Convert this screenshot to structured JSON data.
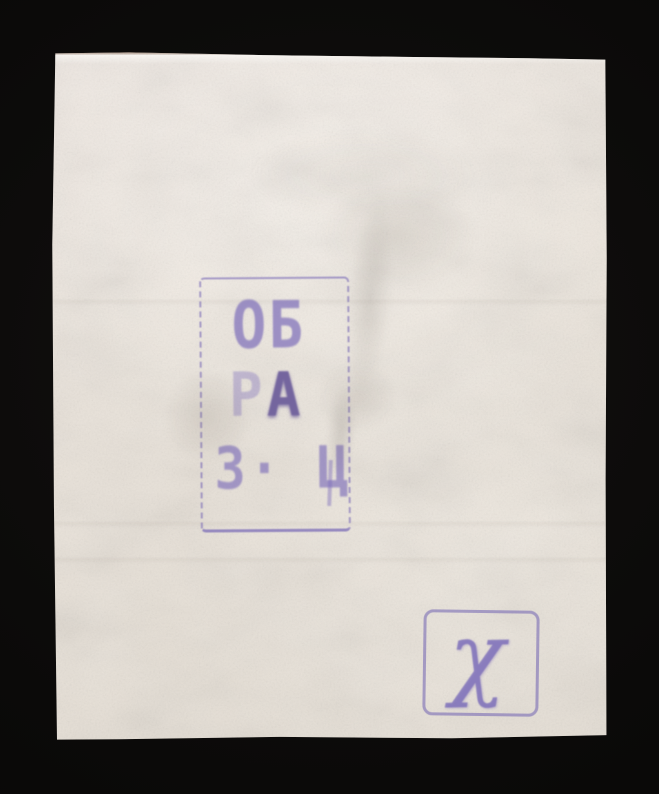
{
  "colors": {
    "background": "#0b0a09",
    "paper": "#eae3da",
    "ink": "#7e6fba",
    "ink_dark": "#655597"
  },
  "specimen_handstamp": {
    "lines": [
      {
        "text": "ОБ"
      },
      {
        "char1": "Р",
        "char2": "А"
      },
      {
        "text": "З· Ц"
      }
    ]
  },
  "control_handstamp": {
    "glyph": "χ"
  }
}
